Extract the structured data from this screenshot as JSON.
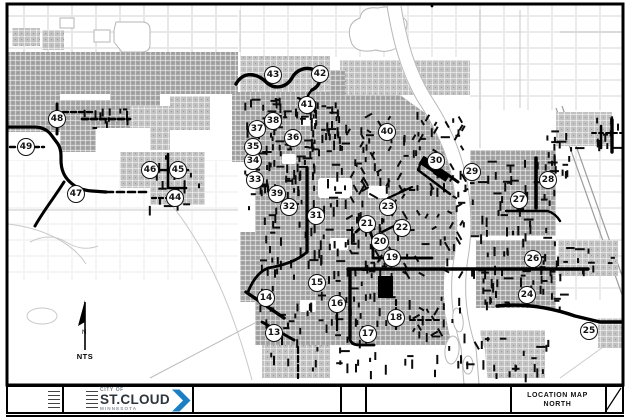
{
  "sheet": {
    "north": {
      "n_label": "N",
      "nts_label": "NTS"
    },
    "logo": {
      "city_of": "CITY OF",
      "name": "ST.CLOUD",
      "state": "MINNESOTA",
      "accent_color": "#1b7fc4"
    },
    "title_cell": {
      "line1": "LOCATION MAP",
      "line2": "NORTH"
    },
    "colors": {
      "map_ink": "#000000",
      "urban_gray": "#a6a6a6"
    }
  },
  "markers": [
    {
      "n": 13,
      "x": 274,
      "y": 333
    },
    {
      "n": 14,
      "x": 266,
      "y": 298
    },
    {
      "n": 15,
      "x": 317,
      "y": 283
    },
    {
      "n": 16,
      "x": 337,
      "y": 304
    },
    {
      "n": 17,
      "x": 368,
      "y": 334
    },
    {
      "n": 18,
      "x": 396,
      "y": 318
    },
    {
      "n": 19,
      "x": 392,
      "y": 258
    },
    {
      "n": 20,
      "x": 380,
      "y": 242
    },
    {
      "n": 21,
      "x": 367,
      "y": 224
    },
    {
      "n": 22,
      "x": 402,
      "y": 228
    },
    {
      "n": 23,
      "x": 388,
      "y": 207
    },
    {
      "n": 24,
      "x": 527,
      "y": 295
    },
    {
      "n": 25,
      "x": 589,
      "y": 331
    },
    {
      "n": 26,
      "x": 533,
      "y": 259
    },
    {
      "n": 27,
      "x": 519,
      "y": 200
    },
    {
      "n": 28,
      "x": 548,
      "y": 180
    },
    {
      "n": 29,
      "x": 472,
      "y": 172
    },
    {
      "n": 30,
      "x": 436,
      "y": 161
    },
    {
      "n": 31,
      "x": 316,
      "y": 216
    },
    {
      "n": 32,
      "x": 289,
      "y": 207
    },
    {
      "n": 33,
      "x": 255,
      "y": 180
    },
    {
      "n": 34,
      "x": 253,
      "y": 161
    },
    {
      "n": 35,
      "x": 253,
      "y": 147
    },
    {
      "n": 36,
      "x": 293,
      "y": 138
    },
    {
      "n": 37,
      "x": 257,
      "y": 129
    },
    {
      "n": 38,
      "x": 273,
      "y": 121
    },
    {
      "n": 39,
      "x": 277,
      "y": 194
    },
    {
      "n": 40,
      "x": 387,
      "y": 132
    },
    {
      "n": 41,
      "x": 307,
      "y": 105
    },
    {
      "n": 42,
      "x": 320,
      "y": 74
    },
    {
      "n": 43,
      "x": 273,
      "y": 75
    },
    {
      "n": 44,
      "x": 175,
      "y": 198
    },
    {
      "n": 45,
      "x": 178,
      "y": 170
    },
    {
      "n": 46,
      "x": 150,
      "y": 170
    },
    {
      "n": 47,
      "x": 76,
      "y": 194
    },
    {
      "n": 48,
      "x": 57,
      "y": 119
    },
    {
      "n": 49,
      "x": 26,
      "y": 147
    }
  ]
}
